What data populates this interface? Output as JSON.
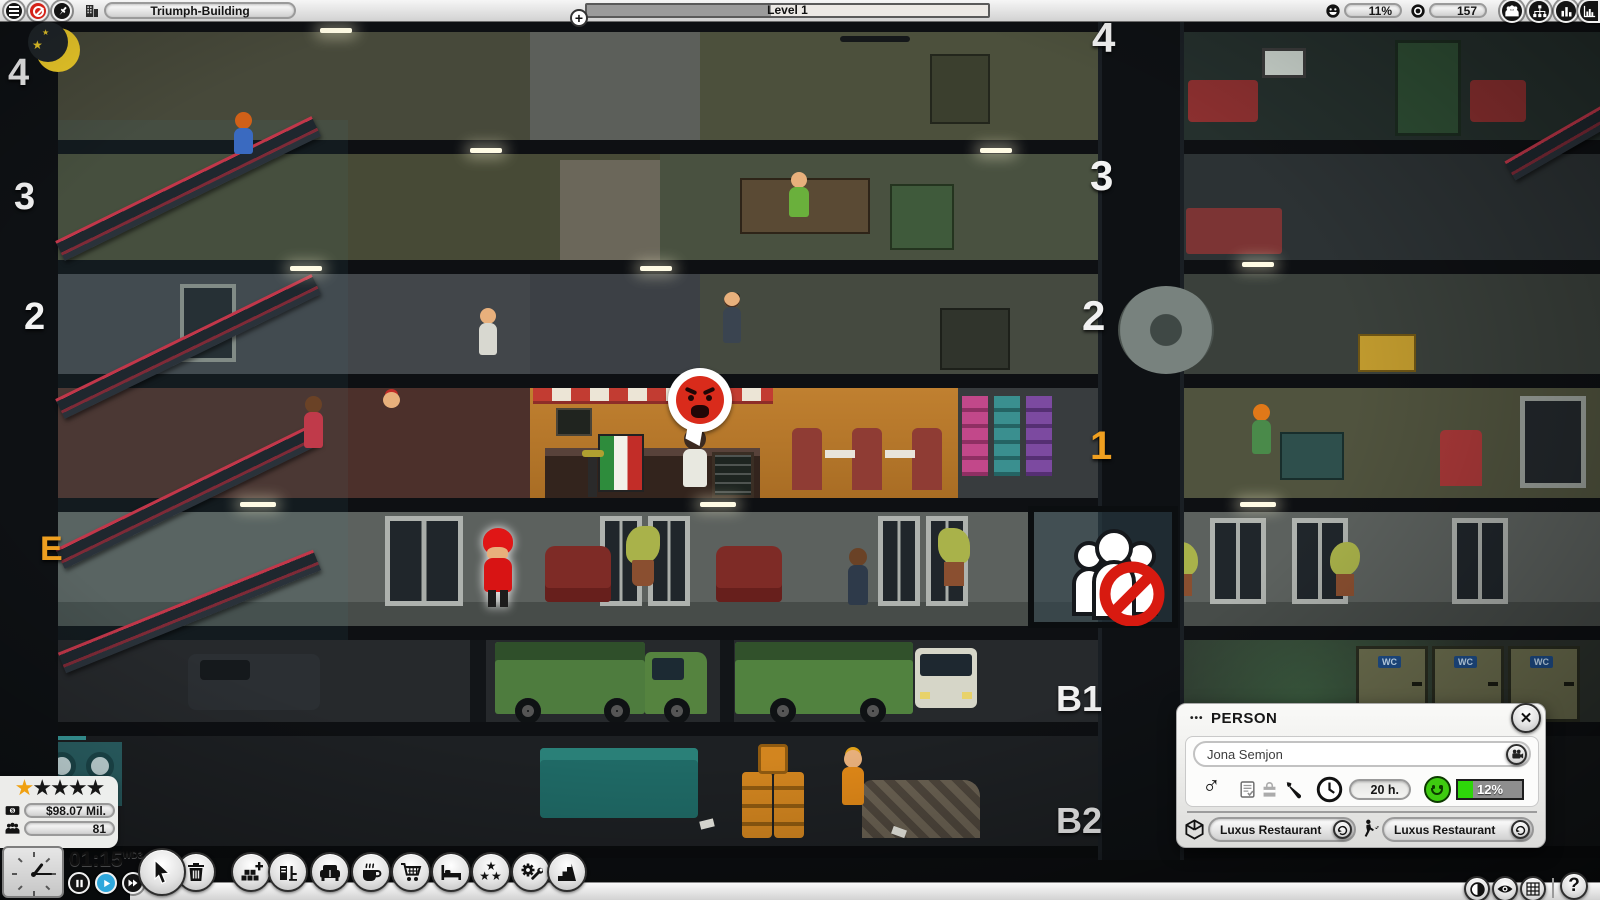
{
  "icons": {
    "star": "★",
    "close": "✕",
    "male": "♂",
    "plus": "+",
    "help": "?",
    "dots": "•••"
  },
  "top_bar": {
    "building_name": "Triumph-Building",
    "level": {
      "label": "Level 1",
      "progress_style": "width:46%"
    },
    "satisfaction": "11%",
    "visitors": "157"
  },
  "hud": {
    "rating": {
      "filled": 1,
      "total": 5
    },
    "money": "$98.07 Mil.",
    "population": "81",
    "time": "01:15",
    "day": "WD3"
  },
  "toolbar": {
    "items": [
      "select",
      "demolish",
      "build-rooms",
      "office-furniture",
      "lounge-furniture",
      "cafe",
      "shop",
      "hotel",
      "decoration",
      "utilities",
      "stairs"
    ]
  },
  "person_panel": {
    "title": "PERSON",
    "name": "Jona Semjon",
    "work_time": "20 h.",
    "happiness": "12%",
    "happiness_style": "width:24%",
    "current_location": "Luxus Restaurant",
    "destination": "Luxus Restaurant"
  },
  "scene": {
    "floor_labels_left": [
      "4",
      "3",
      "2",
      "E"
    ],
    "floor_labels_right": [
      "4",
      "3",
      "2",
      "1",
      "B1",
      "B2"
    ],
    "wc_label": "WC"
  },
  "colors": {
    "star_gold": "#f0a010",
    "play_blue": "#2fa8dc",
    "happiness_green": "#2ed60a",
    "alert_red": "#d92b1b",
    "floor_accent_orange": "#f0a020"
  }
}
